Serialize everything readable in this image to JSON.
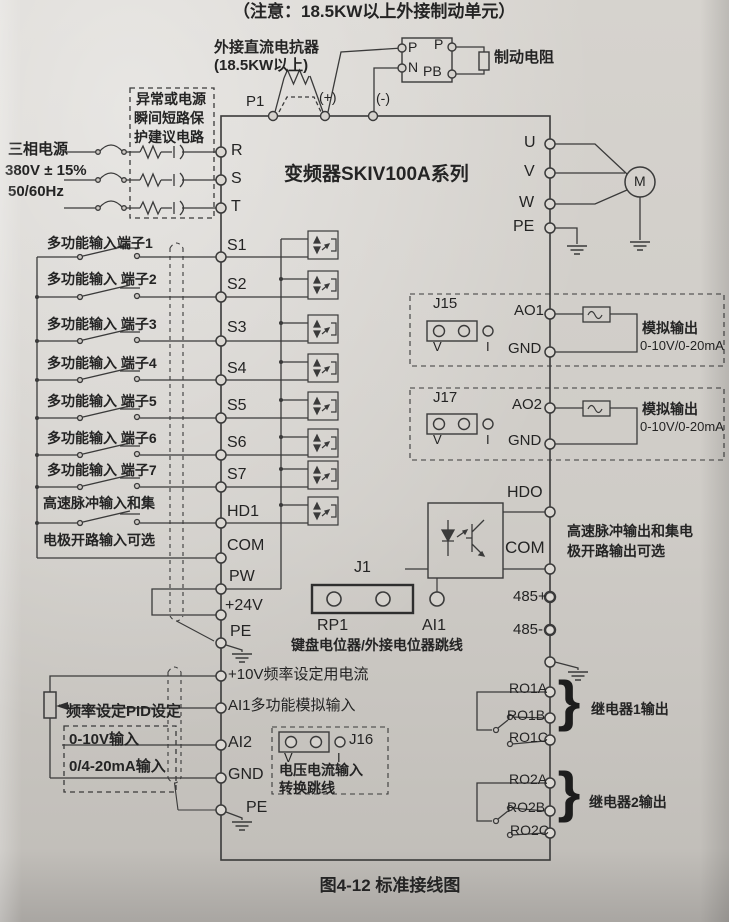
{
  "note_top": "（注意：18.5KW以上外接制动单元）",
  "caption": "图4-12 标准接线图",
  "title": "变频器SKIV100A系列",
  "dc_reactor": {
    "name": "外接直流电抗器",
    "spec": "(18.5KW以上)",
    "p1": "P1",
    "plus": "(+)",
    "minus": "(-)"
  },
  "brake_unit": {
    "p_left": "P",
    "p_right": "P",
    "n": "N",
    "pb": "PB",
    "resistor_label": "制动电阻"
  },
  "power_input": {
    "line1": "三相电源",
    "line2": "380V ± 15%",
    "line3": "50/60Hz",
    "protection1": "异常或电源",
    "protection2": "瞬间短路保",
    "protection3": "护建议电路",
    "r": "R",
    "s": "S",
    "t": "T"
  },
  "motor_output": {
    "u": "U",
    "v": "V",
    "w": "W",
    "pe": "PE",
    "motor": "M"
  },
  "digital_inputs": {
    "rows": [
      {
        "label": "多功能输入端子1",
        "terminal": "S1"
      },
      {
        "label": "多功能输入 端子2",
        "terminal": "S2"
      },
      {
        "label": "多功能输入 端子3",
        "terminal": "S3"
      },
      {
        "label": "多功能输入 端子4",
        "terminal": "S4"
      },
      {
        "label": "多功能输入 端子5",
        "terminal": "S5"
      },
      {
        "label": "多功能输入 端子6",
        "terminal": "S6"
      },
      {
        "label": "多功能输入 端子7",
        "terminal": "S7"
      },
      {
        "label": "高速脉冲输入和集",
        "terminal": "HD1"
      },
      {
        "label": "电极开路输入可选",
        "terminal": "COM"
      }
    ],
    "pw": "PW",
    "v24": "+24V",
    "pe": "PE"
  },
  "keypad_pot": {
    "j1": "J1",
    "rp1": "RP1",
    "ai1": "AI1",
    "note": "键盘电位器/外接电位器跳线"
  },
  "analog_inputs": {
    "v10": "+10V频率设定用电流",
    "ai1": "AI1多功能模拟输入",
    "pid": "频率设定PID设定",
    "ai2": "AI2",
    "gnd": "GND",
    "pe": "PE",
    "range1": "0-10V输入",
    "range2": "0/4-20mA输入",
    "j16": "J16",
    "j16_v": "V",
    "j16_i": "I",
    "j16_note1": "电压电流输入",
    "j16_note2": "转换跳线"
  },
  "analog_outputs": [
    {
      "jumper": "J15",
      "v": "V",
      "i": "I",
      "terminal": "AO1",
      "gnd": "GND",
      "desc1": "模拟输出",
      "desc2": "0-10V/0-20mA"
    },
    {
      "jumper": "J17",
      "v": "V",
      "i": "I",
      "terminal": "AO2",
      "gnd": "GND",
      "desc1": "模拟输出",
      "desc2": "0-10V/0-20mA"
    }
  ],
  "pulse_output": {
    "hdo": "HDO",
    "com": "COM",
    "desc1": "高速脉冲输出和集电",
    "desc2": "极开路输出可选"
  },
  "comm": {
    "rs485_plus": "485+",
    "rs485_minus": "485-"
  },
  "relay_outputs": [
    {
      "a": "RO1A",
      "b": "RO1B",
      "c": "RO1C",
      "desc": "继电器1输出",
      "brace": "}"
    },
    {
      "a": "RO2A",
      "b": "RO2B",
      "c": "RO2C",
      "desc": "继电器2输出",
      "brace": "}"
    }
  ]
}
